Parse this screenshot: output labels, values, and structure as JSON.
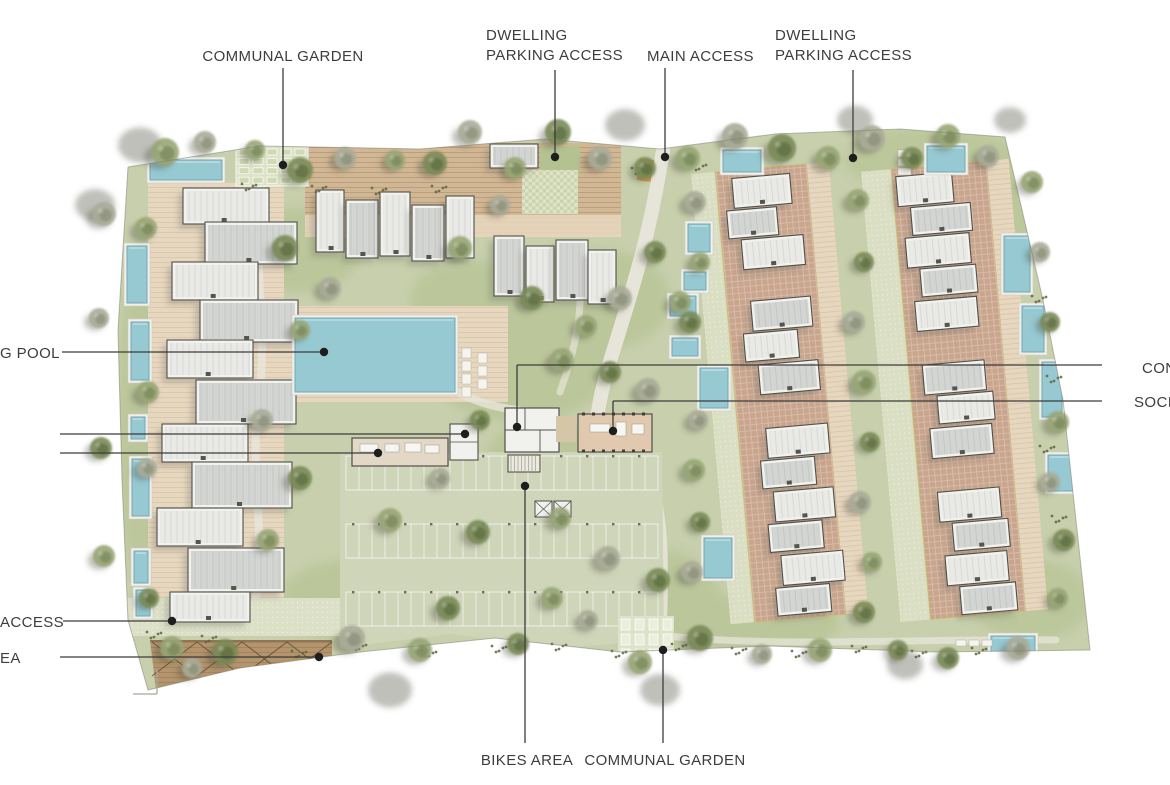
{
  "plan_type": "residential masterplan site plan",
  "palette": {
    "background": "#ffffff",
    "site_green": "#c7cfac",
    "lawn_green": "#b4c190",
    "parking_green": "#cfd5b9",
    "path": "#e7e5d9",
    "deck_tan": "#e7d7bf",
    "deck_brown": "#d2b794",
    "court_brick": "#c9a58d",
    "pergola_brown": "#b3946c",
    "pool_blue": "#97c9d2",
    "pool_edge": "#6fa9b6",
    "building_white": "#f1f1ee",
    "building_gray": "#d3d5d3",
    "building_outline": "#50504a",
    "tree_olive": "#7a8b57",
    "tree_sage": "#98a676",
    "tree_gray": "#a9ac98",
    "tree_dark": "#5e6f45",
    "tree_brown": "#8a8a60",
    "shadow": "rgba(75,74,64,0.35)",
    "leader_line": "#3c3c3c",
    "leader_dot": "#1e1e1e",
    "label_text": "#3d3d3d",
    "accent_orange": "#cf9040"
  },
  "annotations": [
    {
      "id": "communal-garden-top",
      "label": "COMMUNAL GARDEN",
      "segments": [
        [
          283,
          68,
          283,
          165
        ]
      ],
      "dot": [
        283,
        165
      ]
    },
    {
      "id": "dwelling-parking-access-left",
      "label": "DWELLING\nPARKING ACCESS",
      "segments": [
        [
          555,
          70,
          555,
          157
        ]
      ],
      "dot": [
        555,
        157
      ]
    },
    {
      "id": "main-access",
      "label": "MAIN ACCESS",
      "segments": [
        [
          665,
          68,
          665,
          157
        ]
      ],
      "dot": [
        665,
        157
      ]
    },
    {
      "id": "dwelling-parking-access-right",
      "label": "DWELLING\nPARKING ACCESS",
      "segments": [
        [
          853,
          70,
          853,
          158
        ]
      ],
      "dot": [
        853,
        158
      ]
    },
    {
      "id": "pool-label-cut",
      "label": "G POOL",
      "segments": [
        [
          62,
          352,
          324,
          352
        ]
      ],
      "dot": [
        324,
        352
      ]
    },
    {
      "id": "left-leader-upper",
      "label": "",
      "segments": [
        [
          60,
          434,
          465,
          434
        ]
      ],
      "dot": [
        465,
        434
      ]
    },
    {
      "id": "left-leader-lower",
      "label": "",
      "segments": [
        [
          60,
          453,
          378,
          453
        ]
      ],
      "dot": [
        378,
        453
      ]
    },
    {
      "id": "access-label-cut",
      "label": "ACCESS",
      "segments": [
        [
          63,
          621,
          172,
          621
        ]
      ],
      "dot": [
        172,
        621
      ]
    },
    {
      "id": "area-label-cut",
      "label": "EA",
      "segments": [
        [
          60,
          657,
          319,
          657
        ]
      ],
      "dot": [
        319,
        657
      ]
    },
    {
      "id": "con-label-cut",
      "label": "CON",
      "segments": [
        [
          1102,
          365,
          517,
          365
        ],
        [
          517,
          365,
          517,
          427
        ]
      ],
      "dot": [
        517,
        427
      ]
    },
    {
      "id": "socia-label-cut",
      "label": "SOCIA",
      "segments": [
        [
          1102,
          401,
          613,
          401
        ],
        [
          613,
          401,
          613,
          431
        ]
      ],
      "dot": [
        613,
        431
      ]
    },
    {
      "id": "bikes-area",
      "label": "BIKES AREA",
      "segments": [
        [
          525,
          743,
          525,
          486
        ]
      ],
      "dot": [
        525,
        486
      ]
    },
    {
      "id": "communal-garden-bottom",
      "label": "COMMUNAL GARDEN",
      "segments": [
        [
          663,
          743,
          663,
          650
        ]
      ],
      "dot": [
        663,
        650
      ]
    }
  ]
}
